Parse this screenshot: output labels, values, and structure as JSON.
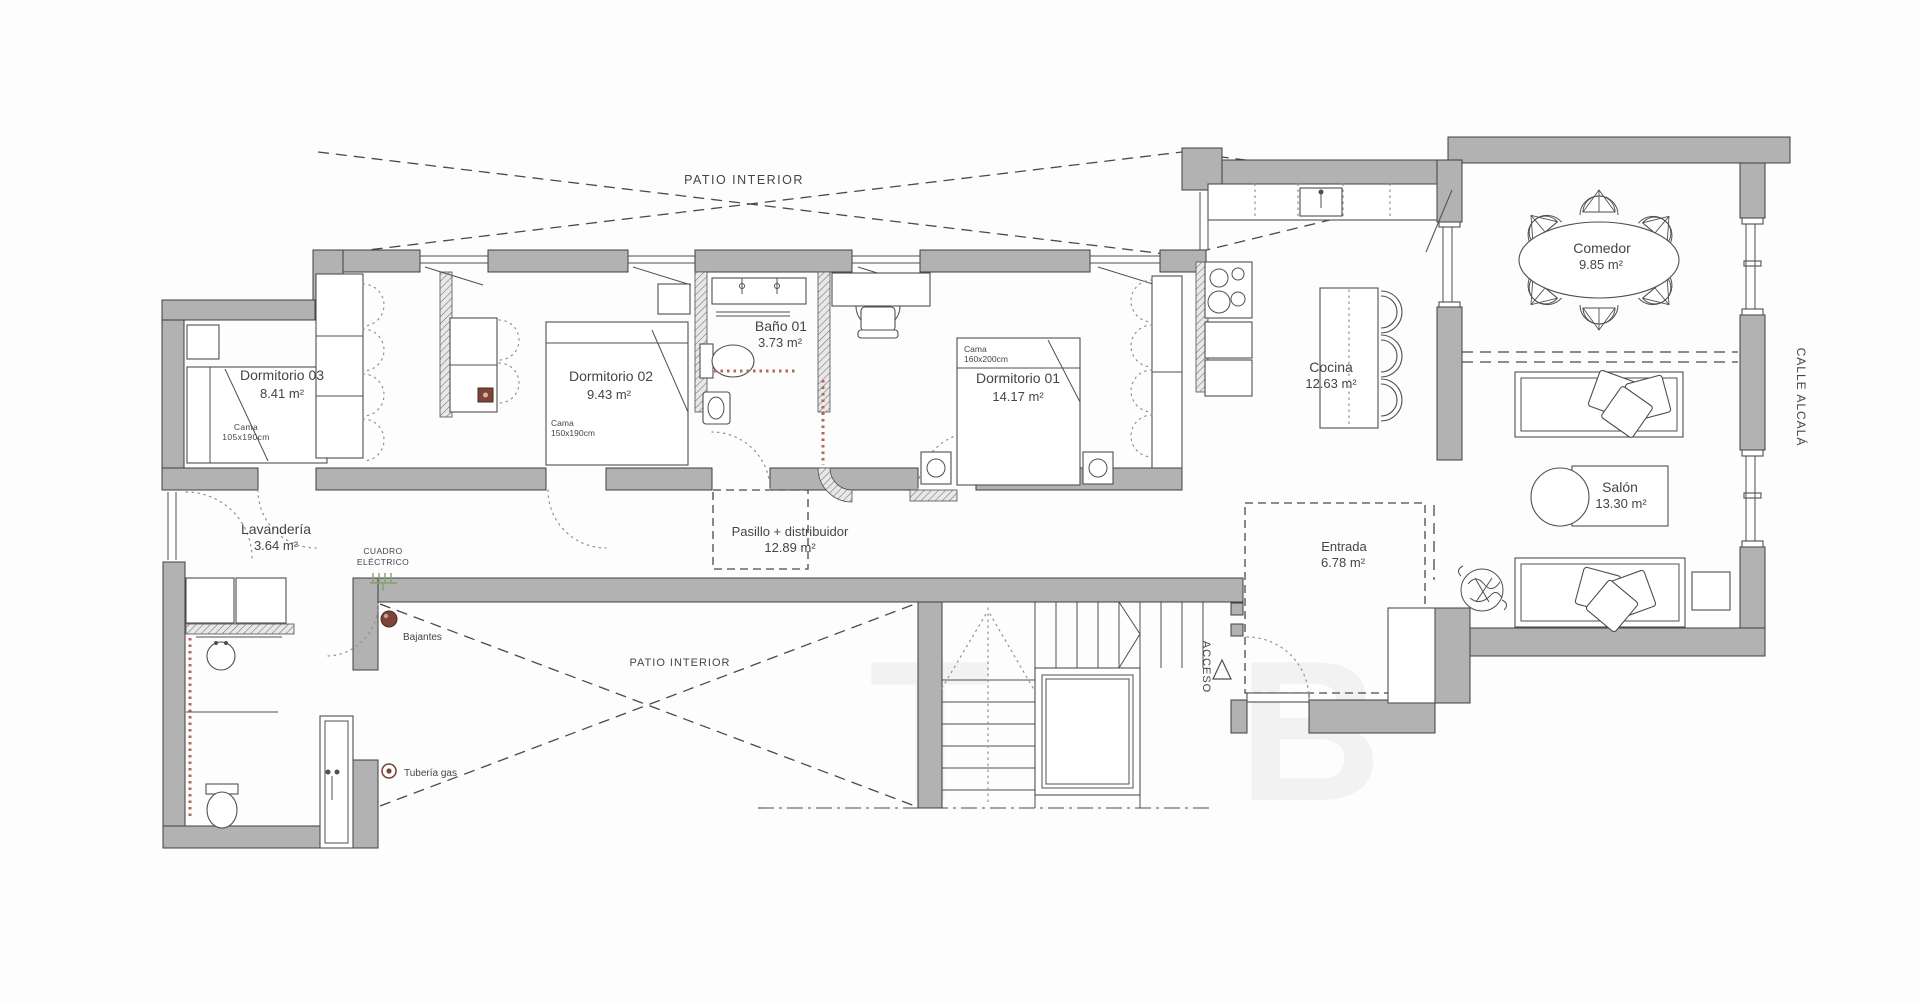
{
  "title": "Floor plan – apartment (Calle Alcalá)",
  "labels": {
    "patio_top": "PATIO INTERIOR",
    "patio_bottom": "PATIO INTERIOR",
    "dorm3_name": "Dormitorio 03",
    "dorm3_area": "8.41 m²",
    "cama3_l1": "Cama",
    "cama3_l2": "105x190cm",
    "dorm2_name": "Dormitorio 02",
    "dorm2_area": "9.43 m²",
    "cama2_l1": "Cama",
    "cama2_l2": "150x190cm",
    "bano1_name": "Baño 01",
    "bano1_area": "3.73 m²",
    "dorm1_name": "Dormitorio 01",
    "dorm1_area": "14.17 m²",
    "cama1_l1": "Cama",
    "cama1_l2": "160x200cm",
    "cocina_name": "Cocina",
    "cocina_area": "12.63 m²",
    "comedor_name": "Comedor",
    "comedor_area": "9.85 m²",
    "salon_name": "Salón",
    "salon_area": "13.30 m²",
    "calle": "CALLE ALCALÁ",
    "lavanderia_name": "Lavandería",
    "lavanderia_area": "3.64 m²",
    "cuadro_l1": "CUADRO",
    "cuadro_l2": "ELÉCTRICO",
    "pasillo_name": "Pasillo + distribuidor",
    "pasillo_area": "12.89 m²",
    "entrada_name": "Entrada",
    "entrada_area": "6.78 m²",
    "acceso": "ACCESO",
    "bajantes": "Bajantes",
    "tuberia": "Tubería gas"
  },
  "watermark": [
    "T",
    "B"
  ],
  "colors": {
    "wall_fill": "#b2b2b2",
    "wall_stroke": "#3f3f3f",
    "line": "#4f4f4f",
    "text": "#454545",
    "dashed": "#4a4a4a",
    "dotted_arc": "#909090",
    "red_dotted": "#b5655c",
    "marker_brown": "#7d4538",
    "marker_green": "#7fa36b"
  }
}
